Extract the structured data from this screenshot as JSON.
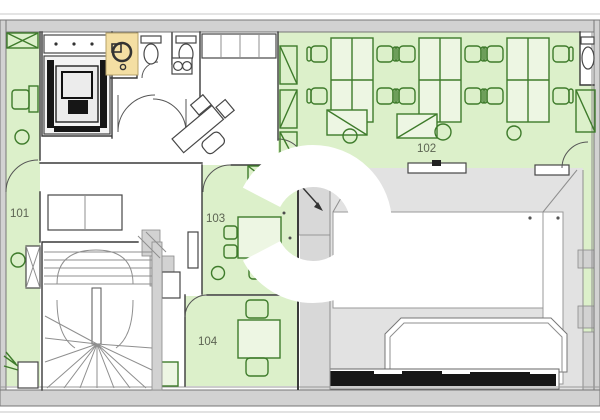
{
  "plan": {
    "name": "office-floor-plan",
    "rooms": [
      {
        "id": "room-101",
        "label": "101"
      },
      {
        "id": "room-102",
        "label": "102"
      },
      {
        "id": "room-103",
        "label": "103"
      },
      {
        "id": "room-104",
        "label": "104"
      }
    ]
  },
  "colors": {
    "room_green": "#dcf0ca",
    "furniture_green": "#3e7b2b",
    "wall_gray": "#d2d2d2",
    "void_gray": "#e2e2e2",
    "inner_gray": "#d8d8d8",
    "accent_tan": "#f4dfa3",
    "ink": "#3a3a3a",
    "dark_fixture": "#161616",
    "label": "#5c6352",
    "outline_gray": "#8a8a8a",
    "watermark_white": "#ffffff"
  }
}
